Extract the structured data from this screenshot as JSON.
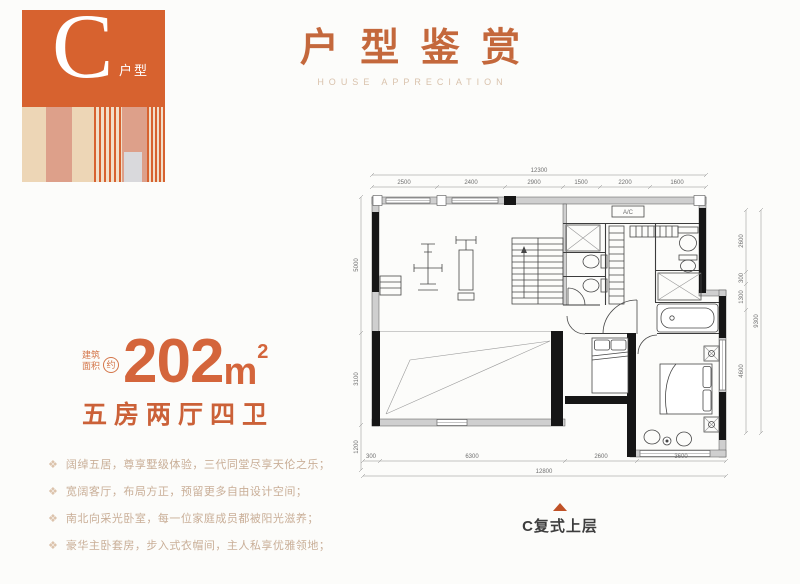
{
  "badge": {
    "letter": "C",
    "label": "户型"
  },
  "header": {
    "title": "户型鉴赏",
    "subtitle": "HOUSE APPRECIATION"
  },
  "area": {
    "prefix_line1": "建筑",
    "prefix_line2": "面积",
    "approx": "约",
    "value": "202",
    "unit": "m",
    "sup": "2",
    "rooms": "五房两厅四卫"
  },
  "features": {
    "bullet": "❖",
    "items": [
      "阔绰五居，尊享墅级体验，三代同堂尽享天伦之乐；",
      "宽阔客厅，布局方正，预留更多自由设计空间；",
      "南北向采光卧室，每一位家庭成员都被阳光滋养；",
      "豪华主卧套房，步入式衣帽间，主人私享优雅领地；"
    ]
  },
  "floorplan": {
    "caption": "C复式上层",
    "ac_label": "A/C",
    "dim_labels": [
      {
        "t": "12300",
        "x": 539,
        "y": 172
      },
      {
        "t": "2500",
        "x": 404,
        "y": 184
      },
      {
        "t": "2400",
        "x": 471,
        "y": 184
      },
      {
        "t": "2900",
        "x": 534,
        "y": 184
      },
      {
        "t": "1500",
        "x": 581,
        "y": 184
      },
      {
        "t": "2200",
        "x": 625,
        "y": 184
      },
      {
        "t": "1600",
        "x": 677,
        "y": 184
      },
      {
        "t": "5000",
        "x": 358,
        "y": 265,
        "r": -90
      },
      {
        "t": "3100",
        "x": 358,
        "y": 379,
        "r": -90
      },
      {
        "t": "1200",
        "x": 358,
        "y": 447,
        "r": -90
      },
      {
        "t": "300",
        "x": 371,
        "y": 458
      },
      {
        "t": "6300",
        "x": 472,
        "y": 458
      },
      {
        "t": "2600",
        "x": 601,
        "y": 458
      },
      {
        "t": "3600",
        "x": 681,
        "y": 458
      },
      {
        "t": "12800",
        "x": 544,
        "y": 473
      },
      {
        "t": "2600",
        "x": 743,
        "y": 241,
        "r": -90
      },
      {
        "t": "300",
        "x": 743,
        "y": 278,
        "r": -90
      },
      {
        "t": "1300",
        "x": 743,
        "y": 297,
        "r": -90
      },
      {
        "t": "4600",
        "x": 743,
        "y": 371,
        "r": -90
      },
      {
        "t": "9300",
        "x": 758,
        "y": 321,
        "r": -90
      }
    ]
  },
  "colors": {
    "accent_orange": "#D7622F",
    "title_orange": "#C4683C",
    "subtitle_tan": "#D9C2AC",
    "area_orange": "#D4653B",
    "feature_text": "#C9AE97",
    "caption_triangle": "#C05227"
  }
}
